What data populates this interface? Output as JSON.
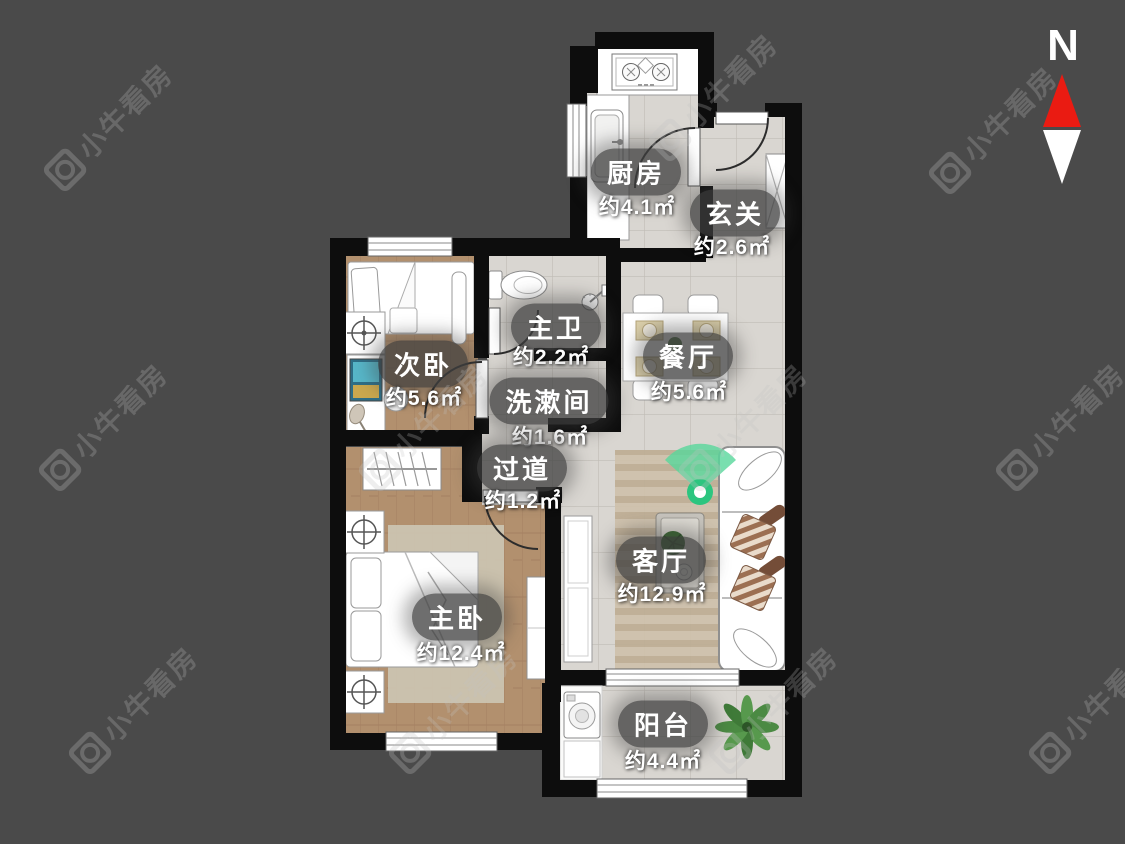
{
  "compass": {
    "label": "N"
  },
  "watermark": {
    "text": "小牛看房"
  },
  "rooms": [
    {
      "id": "kitchen",
      "name": "厨房",
      "area": "约4.1㎡"
    },
    {
      "id": "entry",
      "name": "玄关",
      "area": "约2.6㎡"
    },
    {
      "id": "second-bedroom",
      "name": "次卧",
      "area": "约5.6㎡"
    },
    {
      "id": "master-bathroom",
      "name": "主卫",
      "area": "约2.2㎡"
    },
    {
      "id": "dining-room",
      "name": "餐厅",
      "area": "约5.6㎡"
    },
    {
      "id": "washroom",
      "name": "洗漱间",
      "area": "约1.6㎡"
    },
    {
      "id": "hallway",
      "name": "过道",
      "area": "约1.2㎡"
    },
    {
      "id": "living-room",
      "name": "客厅",
      "area": "约12.9㎡"
    },
    {
      "id": "master-bedroom",
      "name": "主卧",
      "area": "约12.4㎡"
    },
    {
      "id": "balcony",
      "name": "阳台",
      "area": "约4.4㎡"
    }
  ],
  "colors": {
    "background": "#4a4a4a",
    "wall": "#0d0d0d",
    "wood_floor": "#b2906e",
    "tile_floor": "#d9d6d1",
    "marker_green": "#2cc57f",
    "compass_red": "#ea1b12"
  }
}
